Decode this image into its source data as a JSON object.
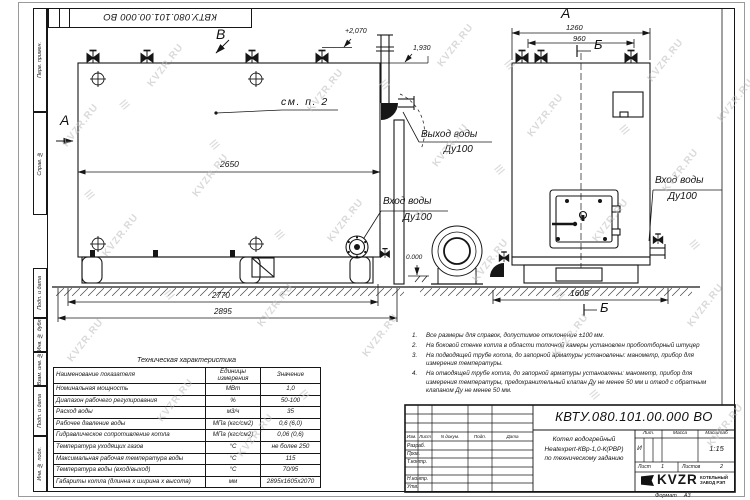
{
  "sheet": {
    "doc_number": "КВТУ.080.101.00.000 ВО",
    "doc_number_top": "КВТУ.080.101.00.000 ВО",
    "format_label": "Формат",
    "format_value": "А3"
  },
  "frame_labels": {
    "top": [
      "Перв. примен.",
      "Справ. №"
    ],
    "bottom": [
      "Подп. и дата",
      "Инв. № дубл.",
      "Взам. инв. №",
      "Подп. и дата",
      "Инв. № подл."
    ]
  },
  "views": {
    "label_a_left": "А",
    "label_b_top": "В",
    "label_a_right": "А",
    "label_b_right_top": "Б",
    "label_b_right_bottom": "Б",
    "see_note": "см. п. 2",
    "outlet_label_1": "Выход воды",
    "outlet_label_2": "Ду100",
    "inlet_label_1": "Вход воды",
    "inlet_label_2": "Ду100",
    "elevation_top": "+2,070",
    "elevation_mid": "1,930",
    "elevation_zero": "0.000",
    "dim_2650": "2650",
    "dim_2770": "2770",
    "dim_2895": "2895",
    "dim_1260": "1260",
    "dim_960": "960",
    "dim_1605": "1605"
  },
  "tech_table": {
    "title": "Техническая характеристика",
    "col_name": "Наименование показателя",
    "col_units": "Единицы измерения",
    "col_value": "Значение",
    "rows": [
      {
        "name": "Номинальная мощность",
        "unit": "МВт",
        "value": "1,0"
      },
      {
        "name": "Диапазон рабочего регулирования",
        "unit": "%",
        "value": "50-100"
      },
      {
        "name": "Расход воды",
        "unit": "м3/ч",
        "value": "35"
      },
      {
        "name": "Рабочее давление воды",
        "unit": "МПа (кгс/см2)",
        "value": "0,6 (6,0)"
      },
      {
        "name": "Гидравлическое сопротивление котла",
        "unit": "МПа (кгс/см2)",
        "value": "0,06 (0,6)"
      },
      {
        "name": "Температура уходящих газов",
        "unit": "°С",
        "value": "не более 250"
      },
      {
        "name": "Максимальная рабочая температура воды",
        "unit": "°С",
        "value": "115"
      },
      {
        "name": "Температура воды (вход/выход)",
        "unit": "°С",
        "value": "70/95"
      },
      {
        "name": "Габариты котла (длинна х ширина х высота)",
        "unit": "мм",
        "value": "2895х1605х2070"
      }
    ]
  },
  "notes": {
    "items": [
      {
        "n": "1.",
        "text": "Все размеры для справок, допустимое отклонение ±100 мм."
      },
      {
        "n": "2.",
        "text": "На боковой стенке котла в области топочной камеры установлен пробоотборный штуцер"
      },
      {
        "n": "3.",
        "text": "На подводящей трубе котла, до запорной арматуры установлены: манометр, прибор для измерения температуры."
      },
      {
        "n": "4.",
        "text": "На отводящей трубе котла, до запорной арматуры установлены: манометр, прибор для измерения температуры, предохранительный клапан Ду не менее 50 мм и отвод с обратным клапаном Ду не менее 50 мм."
      }
    ]
  },
  "title_block": {
    "cols": [
      "Изм.",
      "Лист",
      "N докум.",
      "Подп.",
      "Дата"
    ],
    "roles": [
      "Разраб.",
      "Пров.",
      "Т.контр.",
      "Н.контр.",
      "Утв."
    ],
    "desc_line1": "Котел водогрейный",
    "desc_line2": "Heatexpert-КВр-1,0-К(РВР)",
    "desc_line3": "по техническому заданию",
    "lit_label": "Лит.",
    "mass_label": "Масса",
    "scale_label": "Масштаб",
    "lit_value": "И",
    "scale_value": "1:15",
    "sheet_label": "Лист",
    "sheet_value": "1",
    "sheets_label": "Листов",
    "sheets_value": "2",
    "logo_text": "KVZR",
    "company_line1": "КОТЕЛЬНЫЙ",
    "company_line2": "ЗАВОД РЭП"
  },
  "watermark": {
    "text": "KVZR.RU",
    "glyph": "≡"
  }
}
